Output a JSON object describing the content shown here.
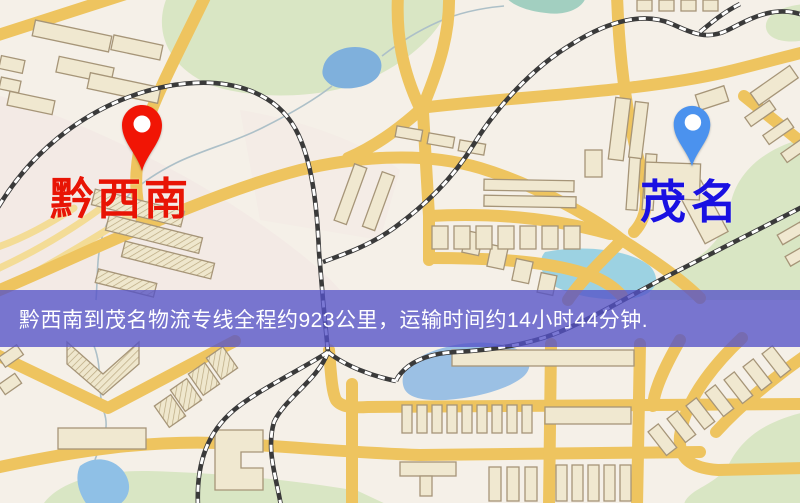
{
  "banner": {
    "text": "黔西南到茂名物流专线全程约923公里，运输时间约14小时44分钟.",
    "background": "#5552c8",
    "text_color": "#ffffff"
  },
  "route": {
    "origin": "黔西南",
    "destination": "茂名",
    "distance_km": "923",
    "duration": "14小时44分钟"
  },
  "markers": {
    "origin": {
      "label": "黔西南",
      "pin_color": "#f11505",
      "label_color": "#e81405"
    },
    "destination": {
      "label": "茂名",
      "pin_color": "#4b92ee",
      "label_color": "#1a11e2"
    }
  },
  "map_colors": {
    "background_cream": "#f5f0e8",
    "road_yellow": "#eec45f",
    "minor_road_yellow": "#f3dc96",
    "building_tan": "#f0e8d0",
    "building_outline": "#a69578",
    "park_green": "#d9e6c4",
    "water_blue": "#7fb0dc",
    "water_cyan": "#9cd2e2",
    "railway_dark": "#3a3a3a"
  }
}
